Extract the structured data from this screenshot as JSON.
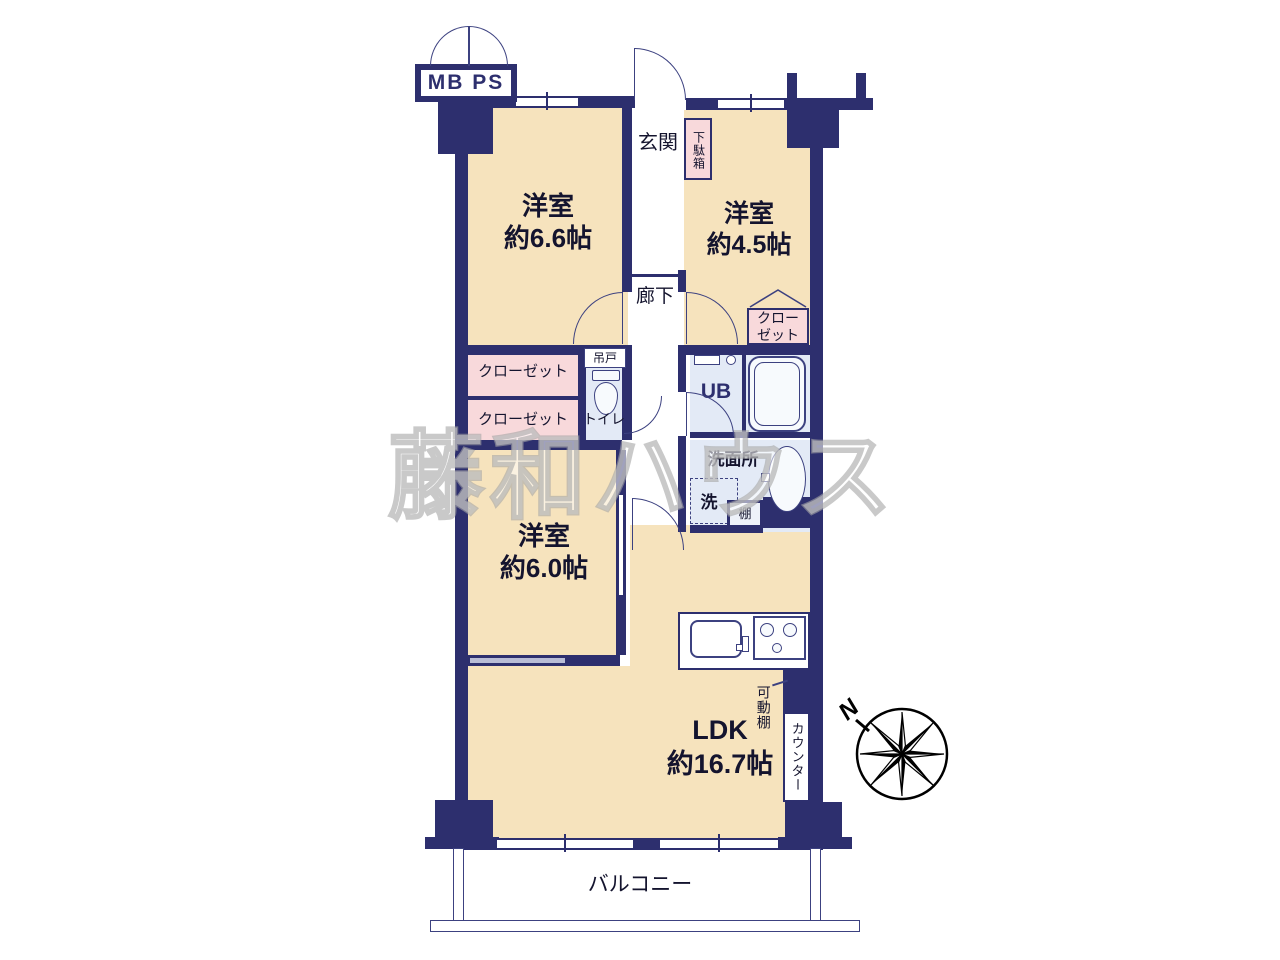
{
  "colors": {
    "wall": "#2d2f6e",
    "room_beige": "#f6e3bd",
    "closet_pink": "#f8d9db",
    "wet_area_blue": "#e3eaf6",
    "watermark_gray": "#c9c9c9"
  },
  "labels": {
    "mbps": "MB PS",
    "genkan": "玄関",
    "getabako": "下駄箱",
    "room66_name": "洋室",
    "room66_size": "約6.6帖",
    "room45_name": "洋室",
    "room45_size": "約4.5帖",
    "room60_name": "洋室",
    "room60_size": "約6.0帖",
    "ldk_name": "LDK",
    "ldk_size": "約16.7帖",
    "rouka": "廊下",
    "closet1": "クローゼット",
    "closet2": "クローゼット",
    "closet3_line1": "クロー",
    "closet3_line2": "ゼット",
    "tsurido": "吊戸",
    "toilet": "トイレ",
    "unit_bath": "UB",
    "senmenjo": "洗面所",
    "washer": "洗",
    "shelf": "棚",
    "movable_shelf": "可動棚",
    "counter": "カウンター",
    "balcony": "バルコニー",
    "compass_north": "N",
    "watermark": "藤和ハウス"
  }
}
